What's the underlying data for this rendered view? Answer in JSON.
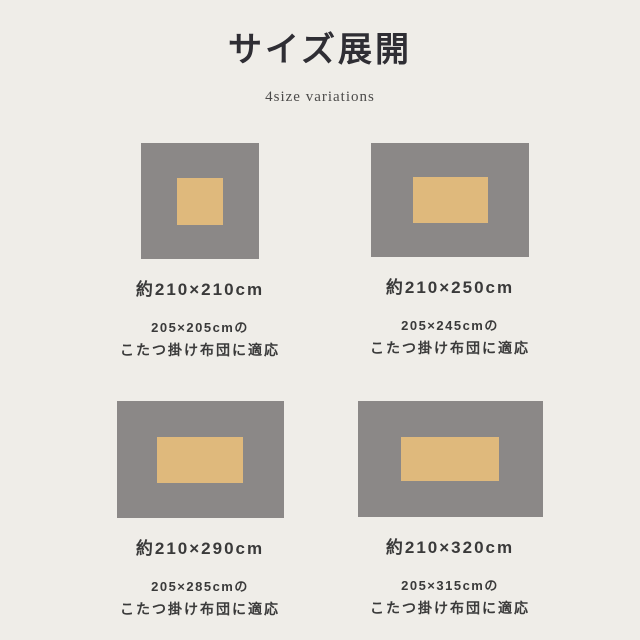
{
  "page": {
    "title": "サイズ展開",
    "subtitle": "4size variations"
  },
  "colors": {
    "background": "#efede8",
    "rug_outer": "#8b8887",
    "rug_inner": "#dfb97c",
    "text_main": "#3a3a3a",
    "text_title": "#2f2e34"
  },
  "variations": [
    {
      "size_label": "約210×210cm",
      "desc_line1": "205×205cmの",
      "desc_line2": "こたつ掛け布団に適応"
    },
    {
      "size_label": "約210×250cm",
      "desc_line1": "205×245cmの",
      "desc_line2": "こたつ掛け布団に適応"
    },
    {
      "size_label": "約210×290cm",
      "desc_line1": "205×285cmの",
      "desc_line2": "こたつ掛け布団に適応"
    },
    {
      "size_label": "約210×320cm",
      "desc_line1": "205×315cmの",
      "desc_line2": "こたつ掛け布団に適応"
    }
  ]
}
